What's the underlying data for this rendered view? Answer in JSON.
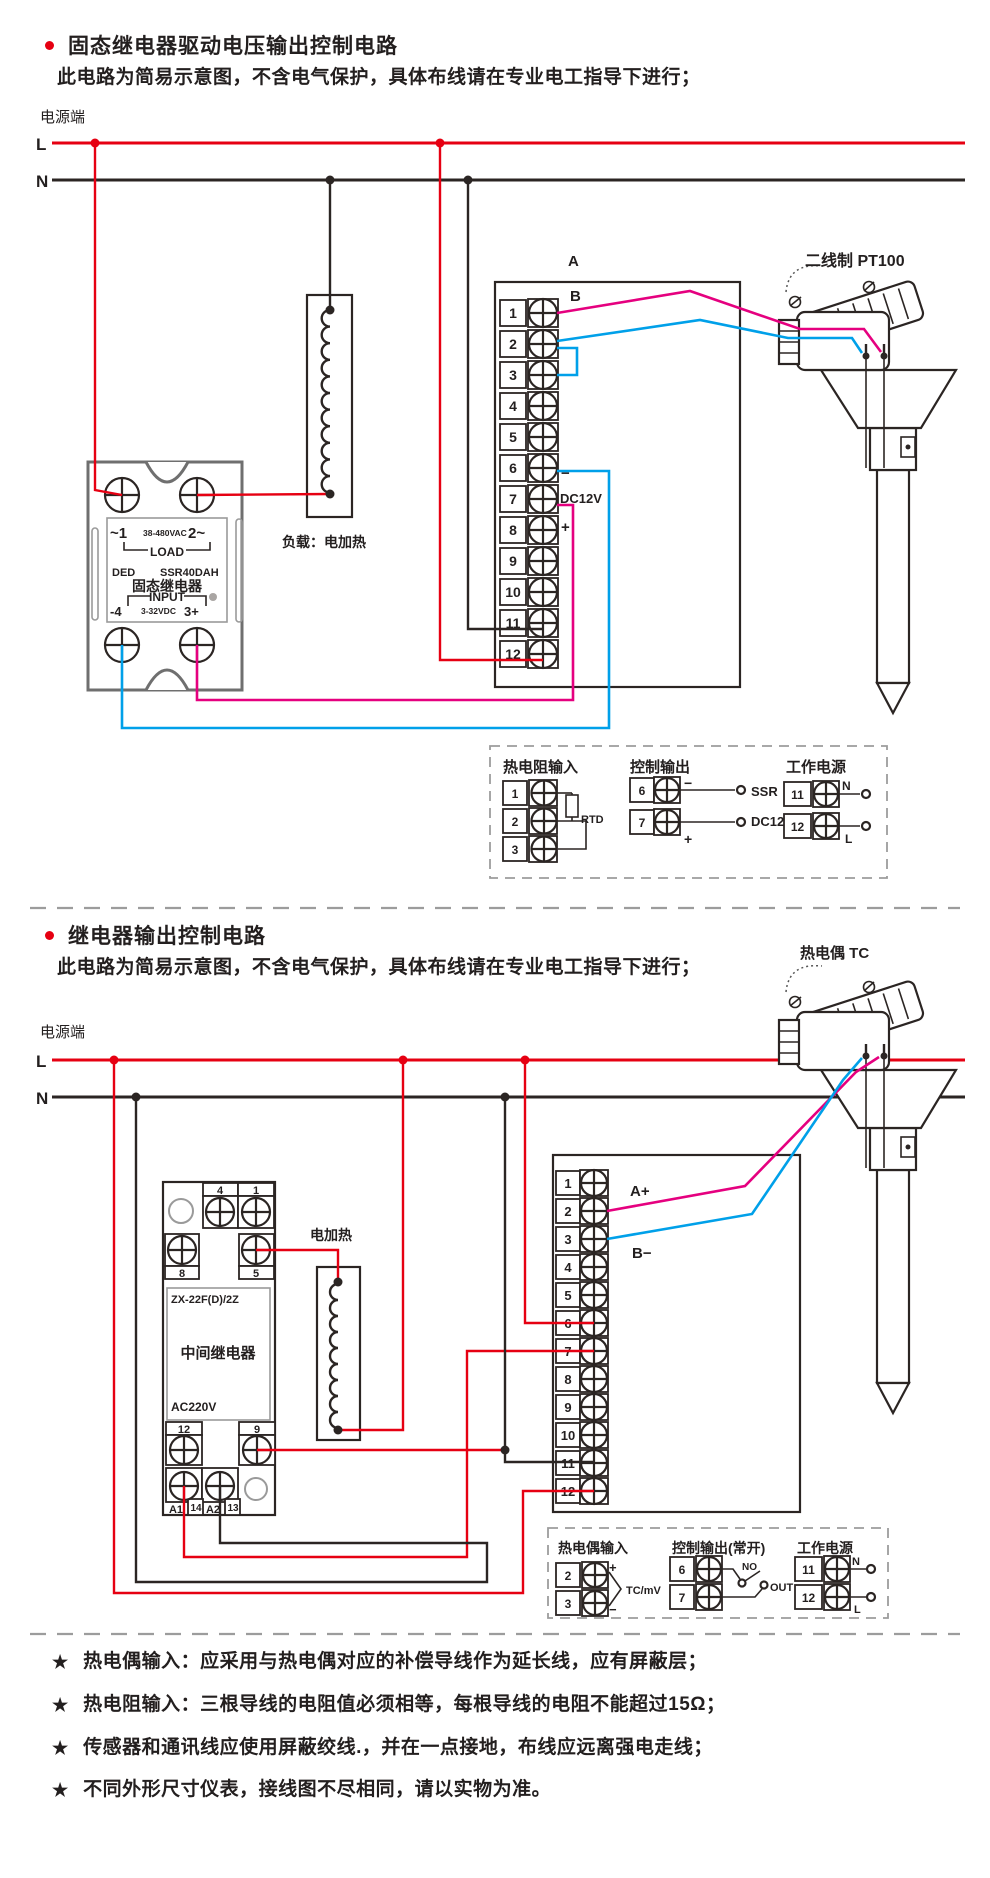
{
  "section1": {
    "bullet_title": "固态继电器驱动电压输出控制电路",
    "subtitle": "此电路为简易示意图，不含电气保护，具体布线请在专业电工指导下进行；"
  },
  "section2": {
    "bullet_title": "继电器输出控制电路",
    "subtitle": "此电路为简易示意图，不含电气保护，具体布线请在专业电工指导下进行；"
  },
  "power1": {
    "label": "电源端",
    "l": "L",
    "n": "N"
  },
  "power2": {
    "label": "电源端",
    "l": "L",
    "n": "N"
  },
  "diagram1": {
    "terminals": [
      "1",
      "2",
      "3",
      "4",
      "5",
      "6",
      "7",
      "8",
      "9",
      "10",
      "11",
      "12"
    ],
    "wire_a": "A",
    "wire_b": "B",
    "minus": "−",
    "dc12v": "DC12V",
    "plus": "+",
    "load_label": "负载：电加热",
    "sensor_label": "二线制 PT100",
    "ssr": {
      "ac_left": "~1",
      "ac_mid": "38-480VAC",
      "ac_right": "2~",
      "load": "LOAD",
      "brand": "DED",
      "model": "SSR40DAH",
      "name": "固态继电器",
      "input": "INPUT",
      "dc_left": "-4",
      "dc_mid": "3-32VDC",
      "dc_right": "3+"
    },
    "legend": {
      "rtd_title": "热电阻输入",
      "rtd_terminals": [
        "1",
        "2",
        "3"
      ],
      "rtd_label": "RTD",
      "out_title": "控制输出",
      "out_terminals": [
        "6",
        "7"
      ],
      "out_minus": "−",
      "out_plus": "+",
      "out_label1": "SSR",
      "out_label2": "DC12V",
      "pwr_title": "工作电源",
      "pwr_terminals": [
        "11",
        "12"
      ],
      "pwr_n": "N",
      "pwr_l": "L"
    }
  },
  "diagram2": {
    "terminals": [
      "1",
      "2",
      "3",
      "4",
      "5",
      "6",
      "7",
      "8",
      "9",
      "10",
      "11",
      "12"
    ],
    "wire_a": "A+",
    "wire_b": "B−",
    "heater_label": "电加热",
    "sensor_label": "热电偶 TC",
    "relay": {
      "top_labels": [
        "4",
        "1"
      ],
      "mid_labels": [
        "8",
        "5"
      ],
      "model": "ZX-22F(D)/2Z",
      "name": "中间继电器",
      "voltage": "AC220V",
      "out_labels": [
        "12",
        "9"
      ],
      "coil_labels": [
        "A1",
        "14",
        "A2",
        "13"
      ]
    },
    "legend": {
      "tc_title": "热电偶输入",
      "tc_terminals": [
        "2",
        "3"
      ],
      "tc_plus": "+",
      "tc_minus": "−",
      "tc_label": "TC/mV",
      "out_title": "控制输出(常开)",
      "out_terminals": [
        "6",
        "7"
      ],
      "out_no": "NO",
      "out_out": "OUT",
      "pwr_title": "工作电源",
      "pwr_terminals": [
        "11",
        "12"
      ],
      "pwr_n": "N",
      "pwr_l": "L"
    }
  },
  "footnotes": {
    "star": "★",
    "items": [
      "热电偶输入：应采用与热电偶对应的补偿导线作为延长线，应有屏蔽层；",
      "热电阻输入：三根导线的电阻值必须相等，每根导线的电阻不能超过15Ω；",
      "传感器和通讯线应使用屏蔽绞线.，并在一点接地，布线应远离强电走线；",
      "不同外形尺寸仪表，接线图不尽相同，请以实物为准。"
    ]
  },
  "colors": {
    "line_red": "#e60012",
    "wire_pink": "#e5007f",
    "wire_blue": "#00a0e9",
    "ink": "#2b2523",
    "gray": "#9c9c9c"
  }
}
